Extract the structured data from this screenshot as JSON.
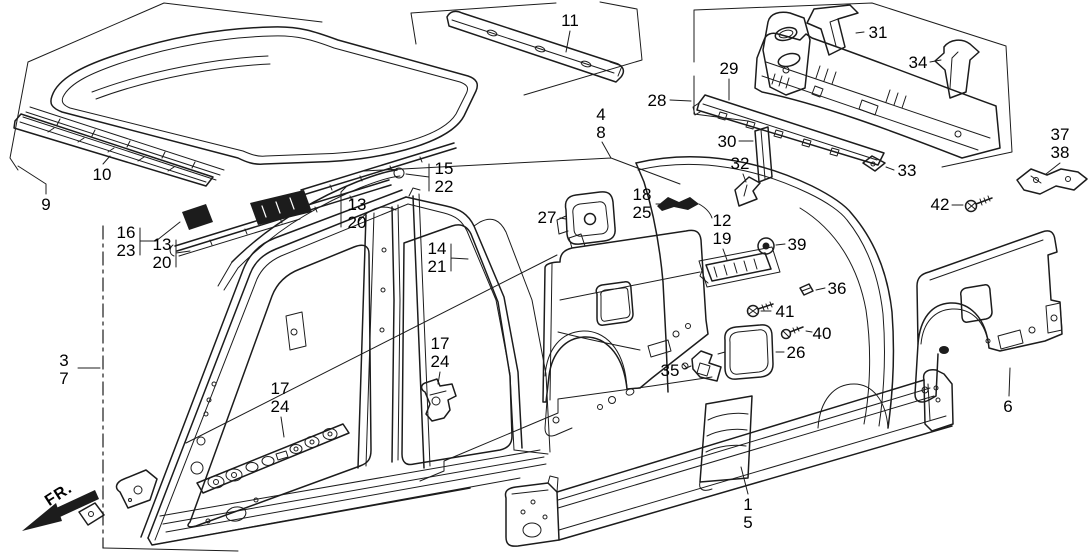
{
  "diagram": {
    "description": "Exploded technical line diagram of car body outer panels (roof, side panels, rear panel, sill, quarter panel) with numbered part callouts",
    "direction_indicator": "FR.",
    "colors": {
      "background": "#ffffff",
      "line": "#1c1c1c",
      "label_text": "#000000"
    },
    "callouts": [
      {
        "id": "9",
        "lines": [
          "9"
        ],
        "x": 46,
        "y": 196
      },
      {
        "id": "10",
        "lines": [
          "10"
        ],
        "x": 102,
        "y": 166
      },
      {
        "id": "11",
        "lines": [
          "11"
        ],
        "x": 570,
        "y": 12
      },
      {
        "id": "16-23",
        "lines": [
          "16",
          "23"
        ],
        "x": 126,
        "y": 224
      },
      {
        "id": "13-20-a",
        "lines": [
          "13",
          "20"
        ],
        "x": 162,
        "y": 236
      },
      {
        "id": "13-20-b",
        "lines": [
          "13",
          "20"
        ],
        "x": 357,
        "y": 196
      },
      {
        "id": "15-22",
        "lines": [
          "15",
          "22"
        ],
        "x": 444,
        "y": 160
      },
      {
        "id": "14-21",
        "lines": [
          "14",
          "21"
        ],
        "x": 437,
        "y": 240
      },
      {
        "id": "27",
        "lines": [
          "27"
        ],
        "x": 547,
        "y": 209
      },
      {
        "id": "4-8",
        "lines": [
          "4",
          "8"
        ],
        "x": 601,
        "y": 106
      },
      {
        "id": "28",
        "lines": [
          "28"
        ],
        "x": 657,
        "y": 92
      },
      {
        "id": "29",
        "lines": [
          "29"
        ],
        "x": 729,
        "y": 60
      },
      {
        "id": "31",
        "lines": [
          "31"
        ],
        "x": 878,
        "y": 24
      },
      {
        "id": "34",
        "lines": [
          "34"
        ],
        "x": 918,
        "y": 54
      },
      {
        "id": "30",
        "lines": [
          "30"
        ],
        "x": 727,
        "y": 133
      },
      {
        "id": "32",
        "lines": [
          "32"
        ],
        "x": 740,
        "y": 155
      },
      {
        "id": "33",
        "lines": [
          "33"
        ],
        "x": 907,
        "y": 162
      },
      {
        "id": "37-38",
        "lines": [
          "37",
          "38"
        ],
        "x": 1060,
        "y": 126
      },
      {
        "id": "42",
        "lines": [
          "42"
        ],
        "x": 940,
        "y": 196
      },
      {
        "id": "18-25",
        "lines": [
          "18",
          "25"
        ],
        "x": 642,
        "y": 186
      },
      {
        "id": "12-19",
        "lines": [
          "12",
          "19"
        ],
        "x": 722,
        "y": 212
      },
      {
        "id": "39",
        "lines": [
          "39"
        ],
        "x": 797,
        "y": 236
      },
      {
        "id": "36",
        "lines": [
          "36"
        ],
        "x": 837,
        "y": 280
      },
      {
        "id": "41",
        "lines": [
          "41"
        ],
        "x": 785,
        "y": 303
      },
      {
        "id": "40",
        "lines": [
          "40"
        ],
        "x": 822,
        "y": 325
      },
      {
        "id": "26",
        "lines": [
          "26"
        ],
        "x": 796,
        "y": 344
      },
      {
        "id": "35",
        "lines": [
          "35"
        ],
        "x": 670,
        "y": 362
      },
      {
        "id": "3-7",
        "lines": [
          "3",
          "7"
        ],
        "x": 64,
        "y": 352
      },
      {
        "id": "17-24-a",
        "lines": [
          "17",
          "24"
        ],
        "x": 280,
        "y": 380
      },
      {
        "id": "17-24-b",
        "lines": [
          "17",
          "24"
        ],
        "x": 440,
        "y": 335
      },
      {
        "id": "6",
        "lines": [
          "6"
        ],
        "x": 1008,
        "y": 398
      },
      {
        "id": "1-5",
        "lines": [
          "1",
          "5"
        ],
        "x": 748,
        "y": 496
      }
    ]
  }
}
